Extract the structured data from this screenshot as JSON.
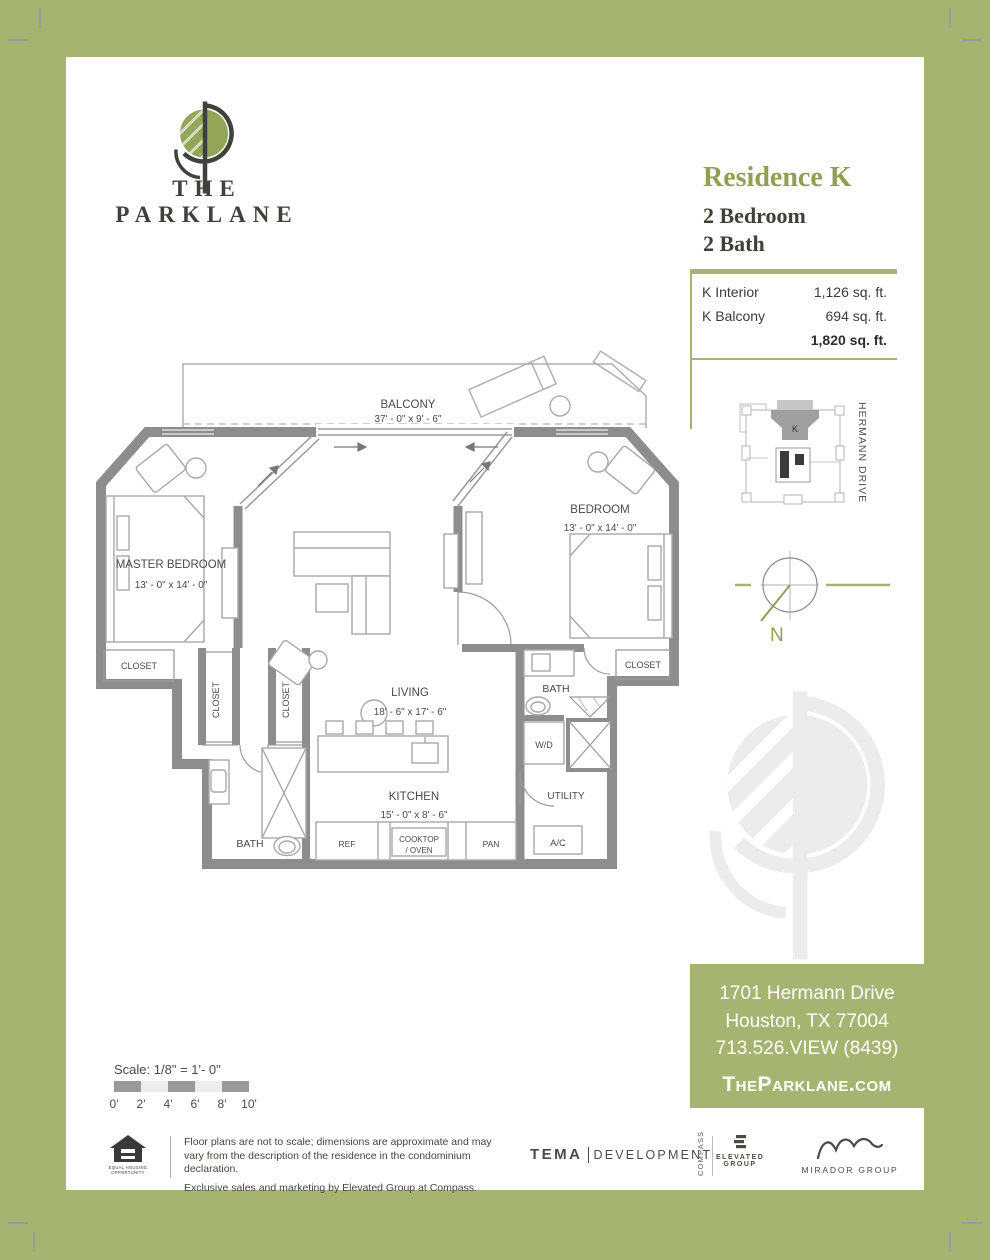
{
  "header": {
    "brand": "THE PARKLANE",
    "residence": "Residence K",
    "bedrooms": "2 Bedroom",
    "baths": "2 Bath"
  },
  "area_table": {
    "rows": [
      {
        "label": "K Interior",
        "value": "1,126 sq. ft."
      },
      {
        "label": "K Balcony",
        "value": "694 sq. ft."
      }
    ],
    "total": "1,820 sq. ft."
  },
  "keyplan": {
    "unit": "K",
    "street": "HERMANN DRIVE"
  },
  "compass": {
    "north": "N"
  },
  "floorplan": {
    "balcony": {
      "name": "BALCONY",
      "dims": "37' - 0\" x 9' - 6\""
    },
    "master_bedroom": {
      "name": "MASTER BEDROOM",
      "dims": "13' - 0\" x 14' - 0\""
    },
    "bedroom": {
      "name": "BEDROOM",
      "dims": "13' - 0\" x 14' - 0\""
    },
    "living": {
      "name": "LIVING",
      "dims": "18' - 6\" x 17' - 6\""
    },
    "kitchen": {
      "name": "KITCHEN",
      "dims": "15' - 0\" x 8' - 6\""
    },
    "closet_label": "CLOSET",
    "bath_label": "BATH",
    "wd_label": "W/D",
    "utility_label": "UTILITY",
    "ac_label": "A/C",
    "ref_label": "REF",
    "cooktop_line1": "COOKTOP",
    "cooktop_line2": "/ OVEN",
    "pan_label": "PAN"
  },
  "scale_bar": {
    "label": "Scale: 1/8\" = 1'- 0\"",
    "ticks": [
      "0'",
      "2'",
      "4'",
      "6'",
      "8'",
      "10'"
    ]
  },
  "contact": {
    "line1": "1701 Hermann Drive",
    "line2": "Houston, TX 77004",
    "line3": "713.526.VIEW (8439)",
    "website": "TheParklane.com"
  },
  "footer": {
    "disclaimer_line1": "Floor plans are not to scale; dimensions are approximate and may vary from the description of the residence in the condominium declaration.",
    "disclaimer_line2": "Exclusive sales and marketing by Elevated Group at Compass.",
    "eho_line1": "EQUAL HOUSING",
    "eho_line2": "OPPORTUNITY",
    "tema_bold": "TEMA",
    "tema_light": "DEVELOPMENT",
    "compass_vertical": "COMPASS",
    "elevated_line1": "ELEVATED",
    "elevated_line2": "GROUP",
    "mirador": "MIRADOR GROUP"
  },
  "colors": {
    "accent_green": "#a6b472",
    "heading_green": "#8fa052",
    "wall_gray": "#8d8d8d"
  }
}
